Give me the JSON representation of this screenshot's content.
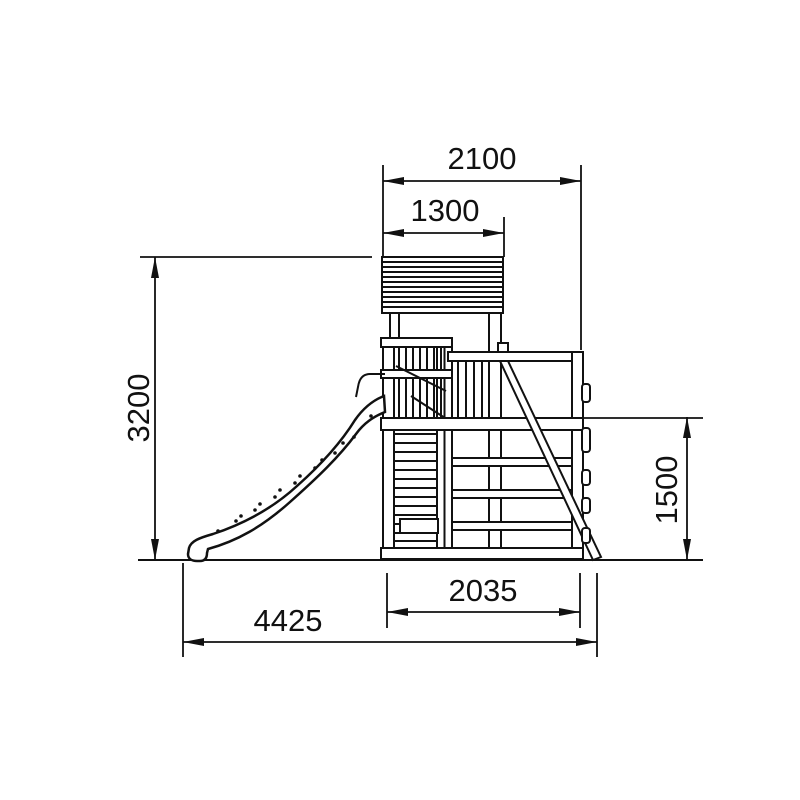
{
  "drawing": {
    "subject": "Playground climbing tower with wave slide — side elevation technical drawing",
    "background_color": "#ffffff",
    "line_color": "#111111",
    "dimensions": {
      "top_width": "2100",
      "roof_width": "1300",
      "overall_height": "3200",
      "platform_height": "1500",
      "base_depth": "2035",
      "overall_depth": "4425"
    }
  }
}
